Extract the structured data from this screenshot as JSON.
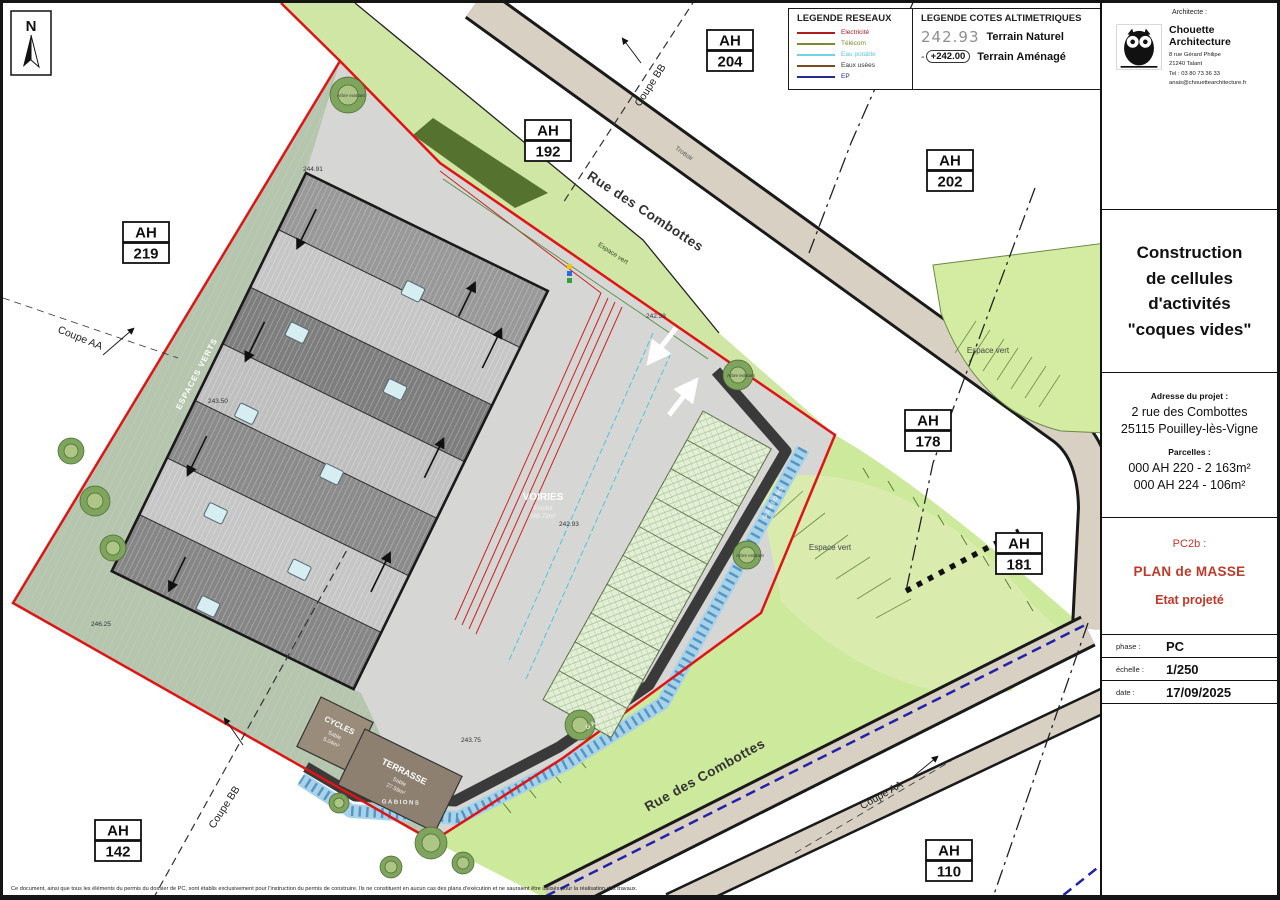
{
  "legend_networks": {
    "title": "LEGENDE RESEAUX",
    "items": [
      {
        "label": "Electricité",
        "line_color": "#aa1e1e",
        "text_color": "#aa1e1e"
      },
      {
        "label": "Télécom",
        "line_color": "#7a8b2a",
        "text_color": "#7a8b2a"
      },
      {
        "label": "Eau potable",
        "line_color": "#6fd4e4",
        "text_color": "#5bc8da"
      },
      {
        "label": "Eaux usées",
        "line_color": "#7a4a22",
        "text_color": "#333333"
      },
      {
        "label": "EP",
        "line_color": "#232a92",
        "text_color": "#232a92"
      }
    ]
  },
  "legend_cotes": {
    "title": "LEGENDE COTES ALTIMETRIQUES",
    "natural_value": "242.93",
    "natural_label": "Terrain Naturel",
    "amenage_value": "+242.00",
    "amenage_label": "Terrain Aménagé"
  },
  "titleblock": {
    "architect_heading": "Architecte :",
    "name": "Chouette Architecture",
    "address1": "8 rue Gérard Philipe",
    "address2": "21240 Talant",
    "tel": "Tel : 03 80 73 36 33",
    "email": "anais@chouettearchitecture.fr",
    "project_line1": "Construction",
    "project_line2": "de cellules",
    "project_line3": "d'activités",
    "project_line4": "\"coques vides\"",
    "address_heading": "Adresse du projet :",
    "project_address1": "2 rue des Combottes",
    "project_address2": "25115 Pouilley-lès-Vigne",
    "parcels_heading": "Parcelles :",
    "parcel1": "000 AH 220 - 2 163m²",
    "parcel2": "000 AH 224 - 106m²",
    "doc_code": "PC2b :",
    "doc_title": "PLAN de MASSE",
    "doc_state": "Etat projeté",
    "phase_label": "phase :",
    "phase_value": "PC",
    "scale_label": "échelle :",
    "scale_value": "1/250",
    "date_label": "date :",
    "date_value": "17/09/2025",
    "accent_color": "#c0392b"
  },
  "plan": {
    "north_label": "N",
    "street_upper": "Rue des Combottes",
    "street_lower": "Rue des Combottes",
    "sidewalk": "Trottoir",
    "coupe_aa": "Coupe AA",
    "coupe_bb": "Coupe BB",
    "parcels": [
      {
        "prefix": "AH",
        "num": "204"
      },
      {
        "prefix": "AH",
        "num": "192"
      },
      {
        "prefix": "AH",
        "num": "202"
      },
      {
        "prefix": "AH",
        "num": "219"
      },
      {
        "prefix": "AH",
        "num": "178"
      },
      {
        "prefix": "AH",
        "num": "181"
      },
      {
        "prefix": "AH",
        "num": "142"
      },
      {
        "prefix": "AH",
        "num": "110"
      }
    ],
    "labels": {
      "espaces_verts": "ESPACES VERTS",
      "espace_vert": "Espace vert",
      "arbre": "Arbre existant",
      "gabions": "GABIONS",
      "voiries": "VOIRIES",
      "voiries_mat": "Enrobé",
      "voiries_area": "585.72m²",
      "cycles": "CYCLES",
      "cycles_mat": "Sable",
      "cycles_area": "5.04m²",
      "terrasse": "TERRASSE",
      "terrasse_mat": "Sable",
      "terrasse_area": "27.59m²"
    },
    "elevations": {
      "e1": "244.91",
      "e2": "243.50",
      "e3": "246.25",
      "e4": "242.38",
      "e5": "242.93",
      "e6": "243.75"
    }
  },
  "footer": {
    "disclaimer": "Ce document, ainsi que tous les éléments du permis du dossier de PC, sont établis exclusivement pour l'instruction du permis de construire. Ils ne constituent en aucun cas des plans d'exécution et ne sauraient être utilisés pour la réalisation des travaux."
  }
}
